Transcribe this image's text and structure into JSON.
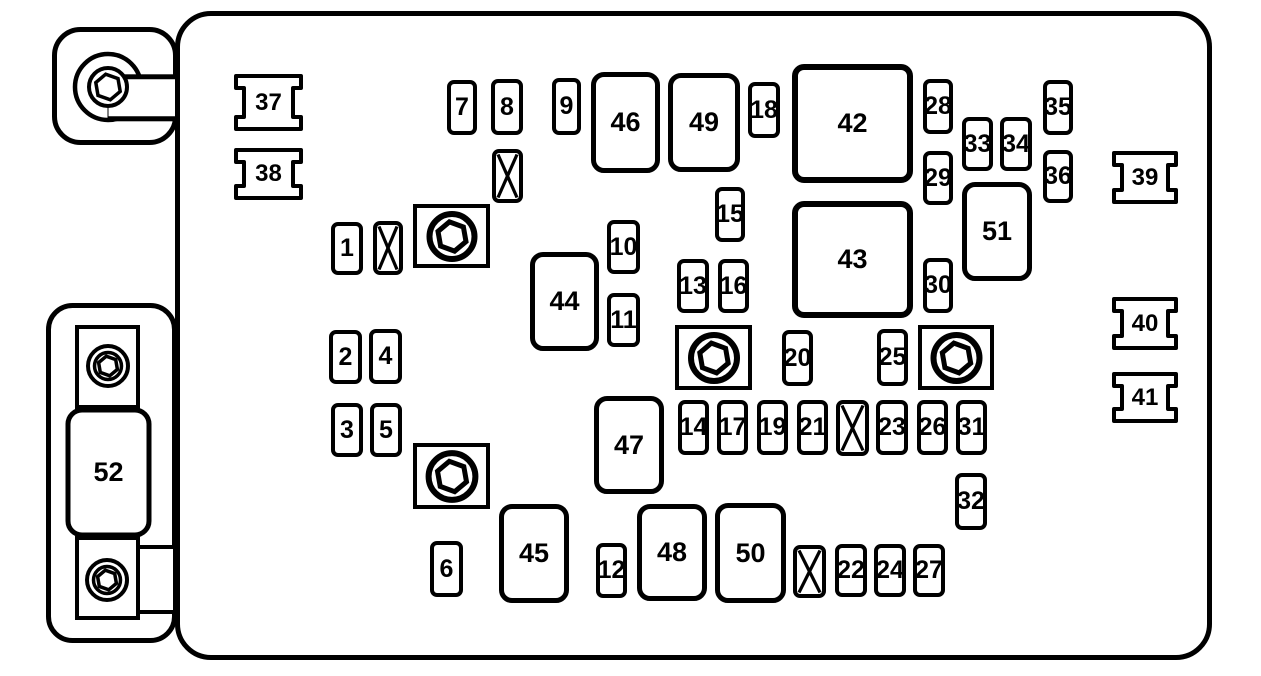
{
  "title": "Engine compartment fuse block diagram",
  "colors": {
    "line": "#000000",
    "background": "#ffffff"
  },
  "diagram": {
    "main_panel": {
      "x": 175,
      "y": 11,
      "w": 1037,
      "h": 649
    },
    "fuses": [
      {
        "label": "1",
        "x": 331,
        "y": 222,
        "w": 32,
        "h": 53,
        "size": "small"
      },
      {
        "label": "2",
        "x": 329,
        "y": 330,
        "w": 33,
        "h": 54,
        "size": "small"
      },
      {
        "label": "3",
        "x": 331,
        "y": 403,
        "w": 32,
        "h": 54,
        "size": "small"
      },
      {
        "label": "4",
        "x": 369,
        "y": 329,
        "w": 33,
        "h": 55,
        "size": "small"
      },
      {
        "label": "5",
        "x": 370,
        "y": 403,
        "w": 32,
        "h": 54,
        "size": "small"
      },
      {
        "label": "6",
        "x": 430,
        "y": 541,
        "w": 33,
        "h": 56,
        "size": "small"
      },
      {
        "label": "7",
        "x": 447,
        "y": 80,
        "w": 30,
        "h": 55,
        "size": "small"
      },
      {
        "label": "8",
        "x": 491,
        "y": 79,
        "w": 32,
        "h": 56,
        "size": "small"
      },
      {
        "label": "9",
        "x": 552,
        "y": 78,
        "w": 29,
        "h": 57,
        "size": "small"
      },
      {
        "label": "10",
        "x": 607,
        "y": 220,
        "w": 33,
        "h": 54,
        "size": "small"
      },
      {
        "label": "11",
        "x": 607,
        "y": 293,
        "w": 33,
        "h": 54,
        "size": "small"
      },
      {
        "label": "12",
        "x": 596,
        "y": 543,
        "w": 31,
        "h": 55,
        "size": "small"
      },
      {
        "label": "13",
        "x": 677,
        "y": 259,
        "w": 32,
        "h": 54,
        "size": "small"
      },
      {
        "label": "14",
        "x": 678,
        "y": 400,
        "w": 31,
        "h": 55,
        "size": "small"
      },
      {
        "label": "15",
        "x": 715,
        "y": 187,
        "w": 30,
        "h": 55,
        "size": "small"
      },
      {
        "label": "16",
        "x": 718,
        "y": 259,
        "w": 31,
        "h": 54,
        "size": "small"
      },
      {
        "label": "17",
        "x": 717,
        "y": 400,
        "w": 31,
        "h": 55,
        "size": "small"
      },
      {
        "label": "18",
        "x": 748,
        "y": 82,
        "w": 32,
        "h": 56,
        "size": "small"
      },
      {
        "label": "19",
        "x": 757,
        "y": 400,
        "w": 31,
        "h": 55,
        "size": "small"
      },
      {
        "label": "20",
        "x": 782,
        "y": 330,
        "w": 31,
        "h": 56,
        "size": "small"
      },
      {
        "label": "21",
        "x": 797,
        "y": 400,
        "w": 31,
        "h": 55,
        "size": "small"
      },
      {
        "label": "22",
        "x": 835,
        "y": 544,
        "w": 32,
        "h": 53,
        "size": "small"
      },
      {
        "label": "23",
        "x": 876,
        "y": 400,
        "w": 32,
        "h": 55,
        "size": "small"
      },
      {
        "label": "24",
        "x": 874,
        "y": 544,
        "w": 32,
        "h": 53,
        "size": "small"
      },
      {
        "label": "25",
        "x": 877,
        "y": 329,
        "w": 31,
        "h": 57,
        "size": "small"
      },
      {
        "label": "26",
        "x": 917,
        "y": 400,
        "w": 31,
        "h": 55,
        "size": "small"
      },
      {
        "label": "27",
        "x": 913,
        "y": 544,
        "w": 32,
        "h": 53,
        "size": "small"
      },
      {
        "label": "28",
        "x": 923,
        "y": 79,
        "w": 30,
        "h": 55,
        "size": "small"
      },
      {
        "label": "29",
        "x": 923,
        "y": 151,
        "w": 30,
        "h": 54,
        "size": "small"
      },
      {
        "label": "30",
        "x": 923,
        "y": 258,
        "w": 30,
        "h": 55,
        "size": "small"
      },
      {
        "label": "31",
        "x": 956,
        "y": 400,
        "w": 31,
        "h": 55,
        "size": "small"
      },
      {
        "label": "32",
        "x": 955,
        "y": 473,
        "w": 32,
        "h": 57,
        "size": "small"
      },
      {
        "label": "33",
        "x": 962,
        "y": 117,
        "w": 31,
        "h": 54,
        "size": "small"
      },
      {
        "label": "34",
        "x": 1000,
        "y": 117,
        "w": 32,
        "h": 54,
        "size": "small"
      },
      {
        "label": "35",
        "x": 1043,
        "y": 80,
        "w": 30,
        "h": 55,
        "size": "small"
      },
      {
        "label": "36",
        "x": 1043,
        "y": 150,
        "w": 30,
        "h": 53,
        "size": "small"
      },
      {
        "label": "42",
        "x": 792,
        "y": 64,
        "w": 121,
        "h": 119,
        "size": "xl"
      },
      {
        "label": "43",
        "x": 792,
        "y": 201,
        "w": 121,
        "h": 117,
        "size": "xl"
      },
      {
        "label": "44",
        "x": 530,
        "y": 252,
        "w": 69,
        "h": 99,
        "size": "large"
      },
      {
        "label": "45",
        "x": 499,
        "y": 504,
        "w": 70,
        "h": 99,
        "size": "large"
      },
      {
        "label": "46",
        "x": 591,
        "y": 72,
        "w": 69,
        "h": 101,
        "size": "large"
      },
      {
        "label": "47",
        "x": 594,
        "y": 396,
        "w": 70,
        "h": 98,
        "size": "large"
      },
      {
        "label": "48",
        "x": 637,
        "y": 504,
        "w": 70,
        "h": 97,
        "size": "large"
      },
      {
        "label": "49",
        "x": 668,
        "y": 73,
        "w": 72,
        "h": 99,
        "size": "large"
      },
      {
        "label": "50",
        "x": 715,
        "y": 503,
        "w": 71,
        "h": 100,
        "size": "large"
      },
      {
        "label": "51",
        "x": 962,
        "y": 182,
        "w": 70,
        "h": 99,
        "size": "large"
      }
    ],
    "blank_fuses": [
      {
        "x": 373,
        "y": 221,
        "w": 30,
        "h": 54
      },
      {
        "x": 492,
        "y": 149,
        "w": 31,
        "h": 54
      },
      {
        "x": 836,
        "y": 400,
        "w": 33,
        "h": 56
      },
      {
        "x": 793,
        "y": 545,
        "w": 33,
        "h": 53
      }
    ],
    "bolt_mounts": [
      {
        "x": 413,
        "y": 204,
        "w": 77,
        "h": 64
      },
      {
        "x": 675,
        "y": 325,
        "w": 77,
        "h": 65
      },
      {
        "x": 918,
        "y": 325,
        "w": 76,
        "h": 65
      },
      {
        "x": 413,
        "y": 443,
        "w": 77,
        "h": 66
      }
    ],
    "clips": [
      {
        "label": "37",
        "x": 234,
        "y": 74,
        "w": 69,
        "h": 57
      },
      {
        "label": "38",
        "x": 234,
        "y": 148,
        "w": 69,
        "h": 52
      },
      {
        "label": "39",
        "x": 1112,
        "y": 151,
        "w": 66,
        "h": 53
      },
      {
        "label": "40",
        "x": 1112,
        "y": 297,
        "w": 66,
        "h": 53
      },
      {
        "label": "41",
        "x": 1112,
        "y": 372,
        "w": 66,
        "h": 51
      }
    ],
    "top_bracket": {
      "x": 52,
      "y": 27,
      "w": 126,
      "h": 118,
      "bolt_cx": 56,
      "bolt_cy": 60
    },
    "bottom_bracket": {
      "x": 46,
      "y": 303,
      "w": 133,
      "h": 341,
      "fuse_label": "52",
      "fuse": {
        "x": 22,
        "y": 107,
        "w": 81,
        "h": 125
      },
      "bolts": [
        {
          "cx": 62,
          "cy": 63
        },
        {
          "cx": 61,
          "cy": 277
        }
      ]
    }
  }
}
